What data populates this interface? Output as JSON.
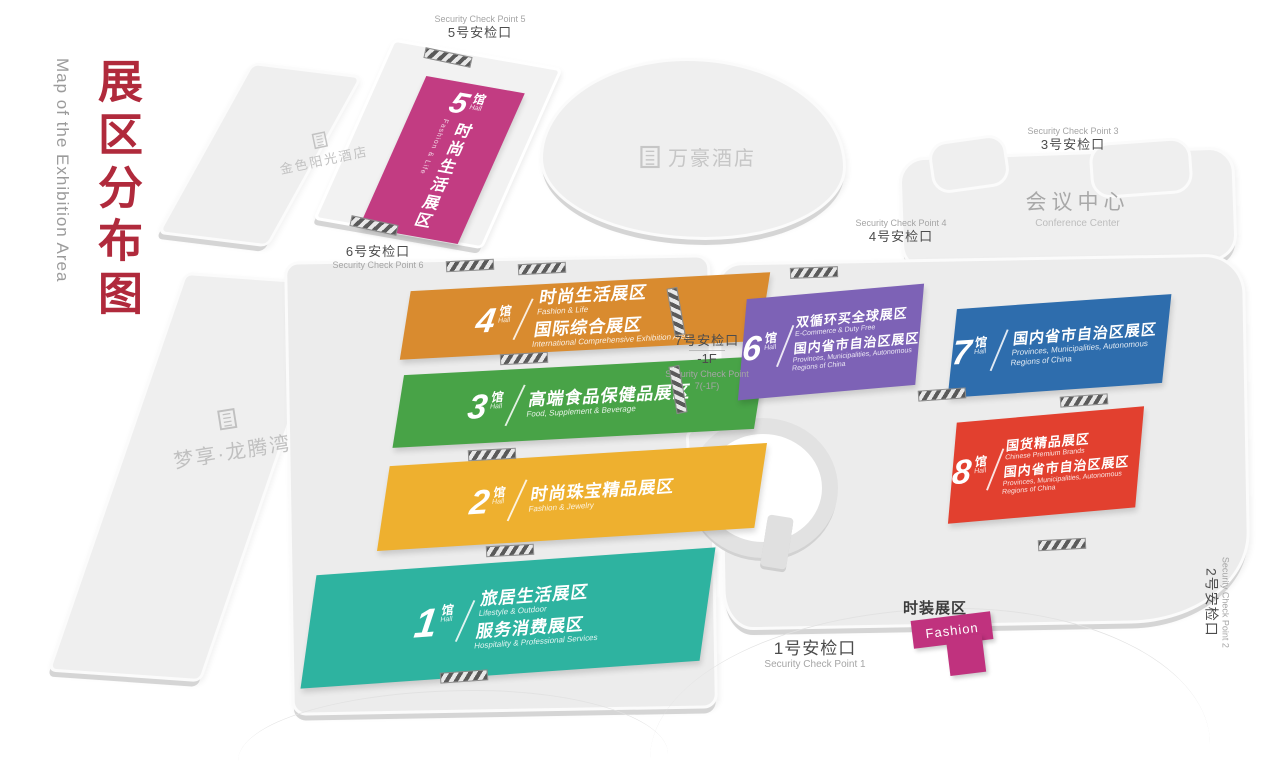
{
  "title": {
    "zh": "展区分布图",
    "en": "Map of the Exhibition Area"
  },
  "labels": {
    "hall_unit_zh": "馆",
    "hall_unit_en": "Hall"
  },
  "icons": {
    "building": "building-icon"
  },
  "colors": {
    "title_red": "#b02a3c",
    "building_gray": "#efefef",
    "hall1": "#2eb3a0",
    "hall2": "#eeb02f",
    "hall3": "#48a347",
    "hall4": "#d98b2f",
    "hall5": "#c23c82",
    "hall6": "#7d62b6",
    "hall7": "#2e6dad",
    "hall8": "#e2402f",
    "fashion": "#c0327e"
  },
  "buildings": {
    "golden_sun_hotel": {
      "label": "金色阳光酒店"
    },
    "marriott_hotel": {
      "label": "万豪酒店"
    },
    "dream_bay": {
      "label": "梦享·龙腾湾"
    },
    "conference_center": {
      "zh": "会议中心",
      "en": "Conference Center"
    }
  },
  "halls": [
    {
      "num": "1",
      "color": "#2eb3a0",
      "lines": [
        {
          "zh": "旅居生活展区",
          "en": "Lifestyle & Outdoor"
        },
        {
          "zh": "服务消费展区",
          "en": "Hospitality & Professional Services"
        }
      ]
    },
    {
      "num": "2",
      "color": "#eeb02f",
      "lines": [
        {
          "zh": "时尚珠宝精品展区",
          "en": "Fashion & Jewelry"
        }
      ]
    },
    {
      "num": "3",
      "color": "#48a347",
      "lines": [
        {
          "zh": "高端食品保健品展区",
          "en": "Food, Supplement & Beverage"
        }
      ]
    },
    {
      "num": "4",
      "color": "#d98b2f",
      "lines": [
        {
          "zh": "时尚生活展区",
          "en": "Fashion & Life"
        },
        {
          "zh": "国际综合展区",
          "en": "International Comprehensive Exhibition Area"
        }
      ]
    },
    {
      "num": "5",
      "color": "#c23c82",
      "lines": [
        {
          "zh": "时尚生活展区",
          "en": "Fashion & Life"
        }
      ]
    },
    {
      "num": "6",
      "color": "#7d62b6",
      "lines": [
        {
          "zh": "双循环买全球展区",
          "en": "E-Commerce & Duty Free"
        },
        {
          "zh": "国内省市自治区展区",
          "en": "Provinces, Municipalities, Autonomous Regions of China"
        }
      ]
    },
    {
      "num": "7",
      "color": "#2e6dad",
      "lines": [
        {
          "zh": "国内省市自治区展区",
          "en": "Provinces, Municipalities, Autonomous Regions of China"
        }
      ]
    },
    {
      "num": "8",
      "color": "#e2402f",
      "lines": [
        {
          "zh": "国货精品展区",
          "en": "Chinese Premium Brands"
        },
        {
          "zh": "国内省市自治区展区",
          "en": "Provinces, Municipalities, Autonomous Regions of China"
        }
      ]
    }
  ],
  "fashion_zone": {
    "zh": "时装展区",
    "en": "Fashion",
    "color": "#c0327e"
  },
  "checkpoints": {
    "cp1": {
      "zh": "1号安检口",
      "en": "Security Check Point 1"
    },
    "cp2": {
      "zh": "2号安检口",
      "en": "Security Check Point 2"
    },
    "cp3": {
      "zh": "3号安检口",
      "en": "Security Check Point 3"
    },
    "cp4": {
      "zh": "4号安检口",
      "en": "Security Check Point 4"
    },
    "cp5": {
      "zh": "5号安检口",
      "en": "Security Check Point 5"
    },
    "cp6": {
      "zh": "6号安检口",
      "en": "Security Check Point 6"
    },
    "cp7": {
      "zh": "7号安检口",
      "floor": "-1F",
      "en": "Security Check Point 7(-1F)"
    }
  }
}
